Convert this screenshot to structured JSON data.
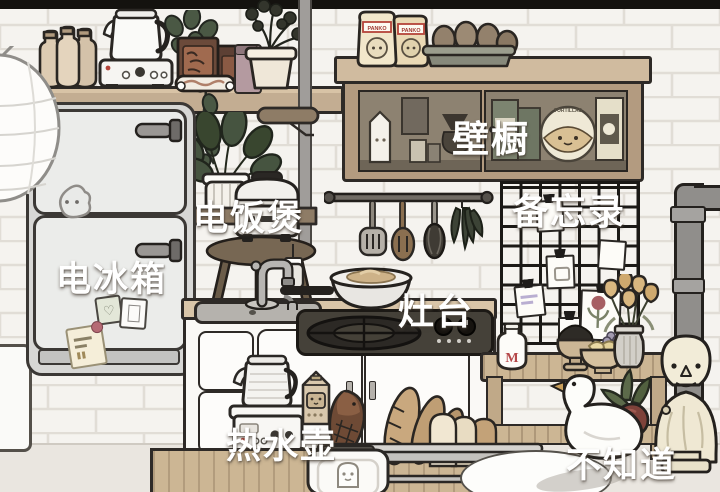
{
  "scene": {
    "type": "game-kitchen-room",
    "style": "toca-life",
    "language": "zh-CN"
  },
  "annotations": {
    "refrigerator": "电冰箱",
    "rice_cooker": "电饭煲",
    "wall_cabinet": "壁橱",
    "memo_board": "备忘录",
    "stove": "灶台",
    "hot_water_kettle": "热水壶",
    "unknown": "不知道"
  },
  "packages": {
    "panko_bag": "PANKO",
    "tortilla_pack": "TORTILLAS",
    "milk_bottle_initial": "M"
  },
  "icons": {
    "heart_magnet": "♡"
  },
  "colors": {
    "wall_tile": "#f5f3ef",
    "tile_grout": "#e1ddd6",
    "wood_light": "#ccb694",
    "wood_dark": "#8e7c66",
    "outline": "#2e2a27",
    "floor": "#eae6e0",
    "label_text": "#ffffff"
  },
  "objects": [
    "paper-lantern",
    "milk-bottles",
    "electric-kettle",
    "hot-plate",
    "snack-packages",
    "ivy-plant",
    "potted-flowers",
    "panko-bags",
    "egg-carton",
    "wall-cabinet",
    "utensil-rail",
    "spatula",
    "slotted-spoon",
    "whisk",
    "dried-herbs",
    "memo-grid",
    "refrigerator",
    "corner-shelf",
    "leaf-plant",
    "rice-cooker",
    "stool",
    "sink-faucet",
    "wok",
    "gas-cooktop",
    "base-cabinets",
    "kettle-cart",
    "milk-carton",
    "taiyaki-bread",
    "baguettes",
    "bread-loaf",
    "serving-rack",
    "toaster",
    "wood-island",
    "round-table",
    "slat-bench",
    "milk-bottle",
    "mortar-bowl",
    "fruit-bowl",
    "flower-vase",
    "goose-planter",
    "bust-statue",
    "wall-pipe"
  ]
}
